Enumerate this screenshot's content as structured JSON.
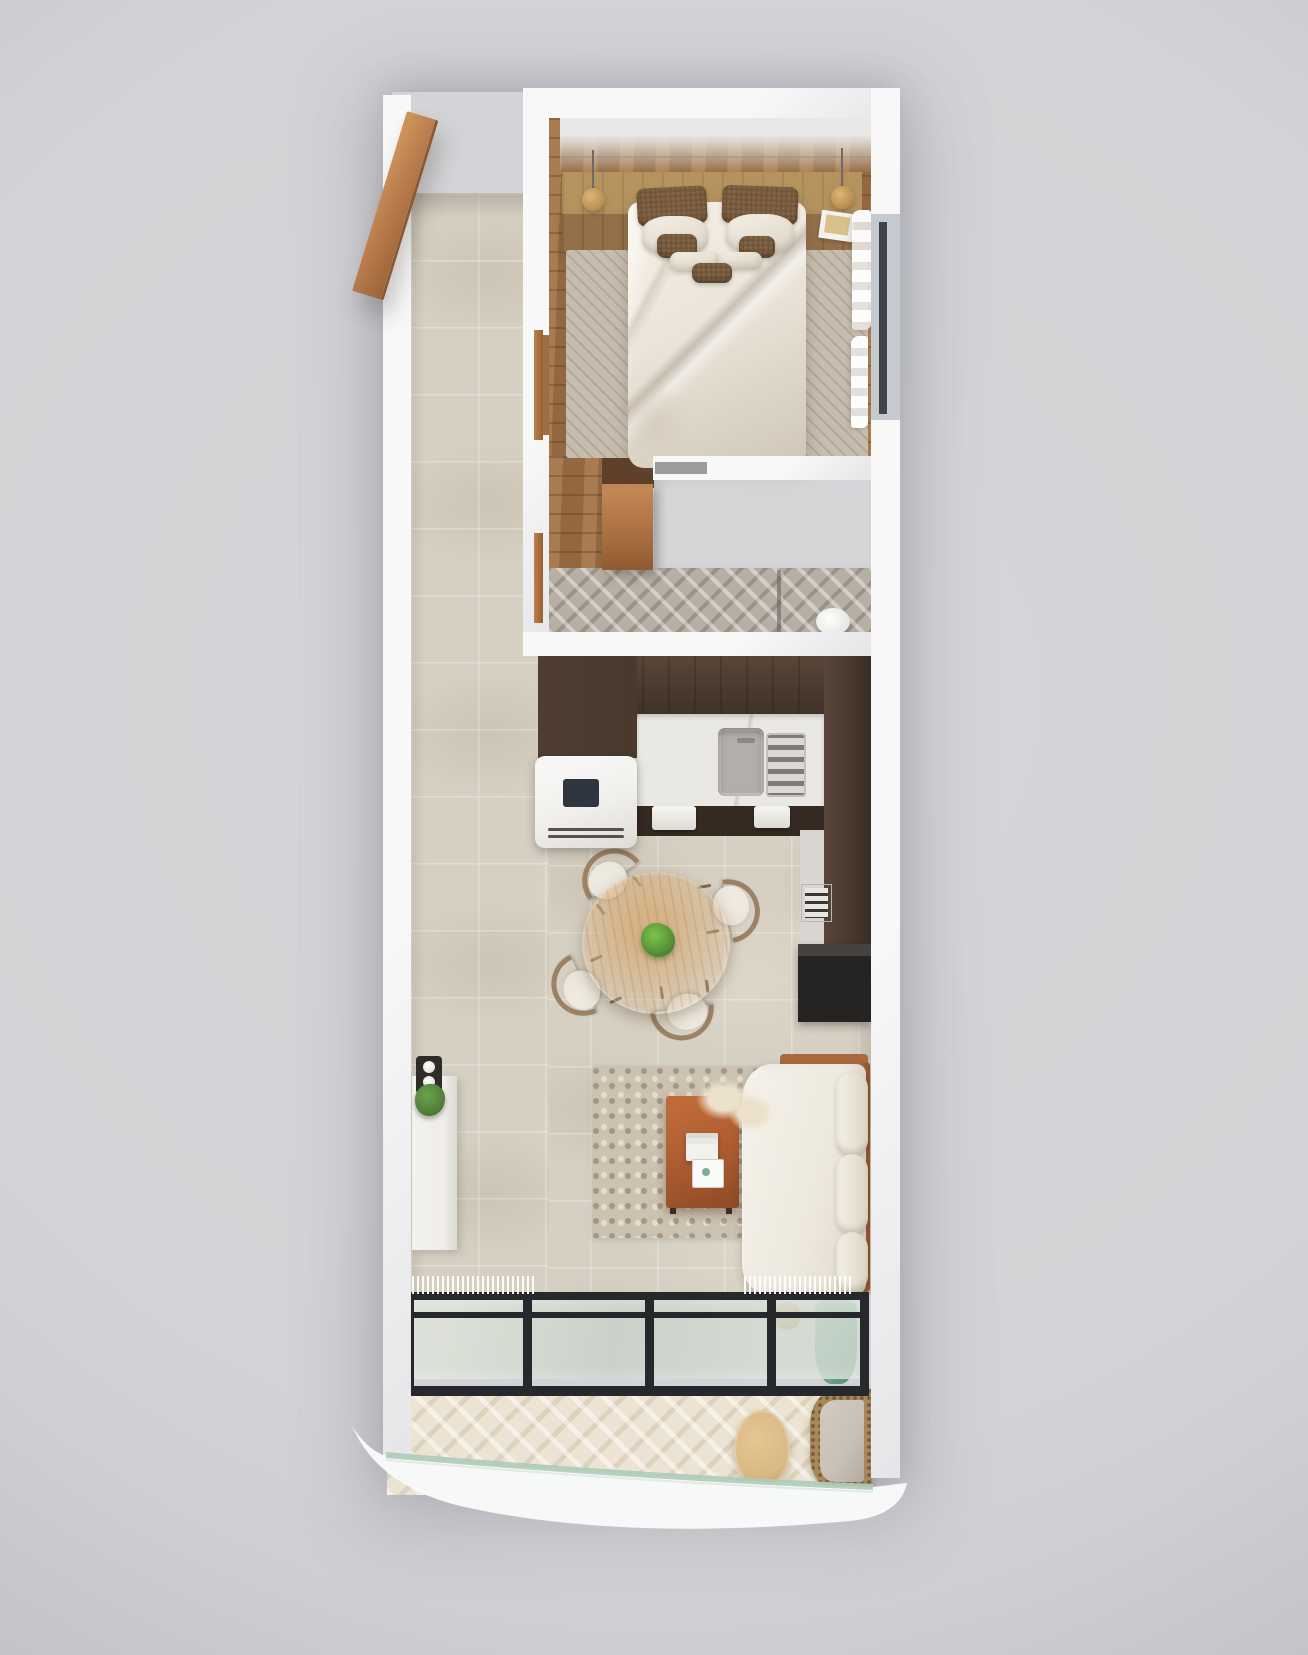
{
  "meta": {
    "scene": "top-down-3d-apartment-floorplan-render",
    "view": "overhead",
    "visible_text": "none"
  },
  "palette": {
    "background": "#d2d3d6",
    "wall_white": "#f8f8f9",
    "floor_tile_beige": "#d6d0c3",
    "wood_floor": "#9c6e44",
    "headboard_oak": "#b4935f",
    "duvet_cream": "#eae4d9",
    "pillow_brown": "#6f543a",
    "door_cognac": "#bc8050",
    "bath_herringbone": "#b7afa4",
    "kitchen_cabinet_dark": "#4a3a2e",
    "counter_marble": "#eae8e4",
    "dining_table_wood": "#c8a476",
    "plant_green": "#559135",
    "living_rug": "#ccc2b2",
    "coffee_table_rust": "#ae5d31",
    "sofa_cream": "#ede8de",
    "tv_cabinet_black": "#262423",
    "glass_frame_black": "#26282b",
    "railing_glass_green": "#aecbb8",
    "balcony_deck": "#ece3d2",
    "rattan_tan": "#a8875a",
    "vase_teal": "#6fa795",
    "window_frame": "#3f444a"
  },
  "rooms": [
    {
      "name": "entry-hall",
      "features": [
        "open-wood-door",
        "beige-tile-floor"
      ]
    },
    {
      "name": "bedroom",
      "features": [
        "double-bed-white-duvet",
        "wood-headboard-with-nightstands",
        "two-pendant-lamps",
        "speckled-brown-pillows",
        "striped-area-rug",
        "wood-plank-floor",
        "window-with-sheer-curtains",
        "book-on-nightstand"
      ]
    },
    {
      "name": "bathroom",
      "features": [
        "herringbone-tile-floor",
        "open-cognac-door",
        "white-vanity-volume",
        "shower-glass-divider",
        "toilet"
      ]
    },
    {
      "name": "kitchen",
      "features": [
        "dark-wood-cabinets-L-shape",
        "marble-counter",
        "sink",
        "dish-rack",
        "white-fridge",
        "built-in-oven",
        "hanging-towels"
      ]
    },
    {
      "name": "dining",
      "features": [
        "round-wood-table",
        "green-centerpiece-plant",
        "four-wood-chairs-with-cushions"
      ]
    },
    {
      "name": "living",
      "features": [
        "chunky-textured-rug",
        "rust-coffee-table",
        "book-stack",
        "cream-throw",
        "white-sofa-with-bolsters",
        "black-tv-cabinet",
        "white-console",
        "candle-tray",
        "potted-plant"
      ]
    },
    {
      "name": "balcony",
      "features": [
        "black-framed-glass-sliding-wall",
        "fringe-curtains",
        "herringbone-deck",
        "round-wood-side-table",
        "rattan-lounge-chair",
        "teal-vase",
        "curved-glass-railing"
      ]
    }
  ]
}
